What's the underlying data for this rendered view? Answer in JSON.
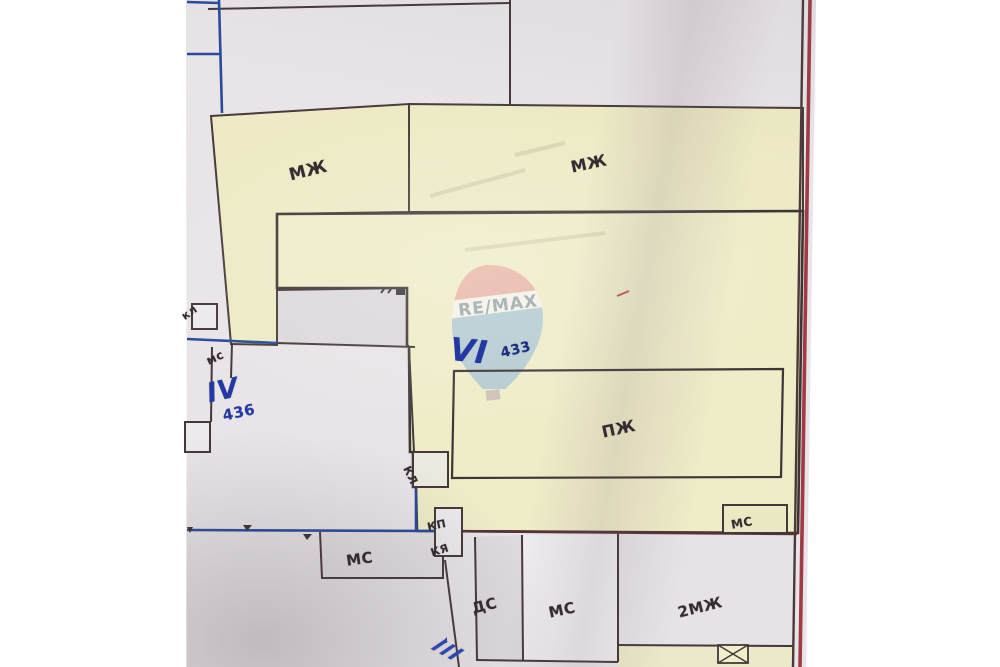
{
  "watermark": {
    "brand_text": "RE/MAX"
  },
  "map_labels": {
    "parcel_top_left_mzh": "МЖ",
    "parcel_top_right_mzh": "МЖ",
    "building_pzh": "ПЖ",
    "outbuilding_ms_right": "МС",
    "outbuilding_kl_left": "кл",
    "outbuilding_ms_left": "мс",
    "parcel_iv_roman": "IV",
    "parcel_iv_number": "436",
    "parcel_vi_roman": "VI",
    "parcel_vi_number": "433",
    "outbuilding_kl_box": "КЛ",
    "outbuilding_kp": "КП",
    "outbuilding_kya": "КЯ",
    "building_ms_bottom_left": "МС",
    "building_ds": "ДС",
    "building_ms_bottom_mid": "МС",
    "building_2mzh": "2МЖ",
    "street_iii_roman": "III"
  },
  "colors": {
    "paper": "#e8e4e7",
    "parcel_yellow": "#edeac5",
    "line_dark": "#43393a",
    "line_blue": "#2a4a9a",
    "border_red": "#a03a44",
    "annotation_blue": "#2438a2",
    "watermark_pink": "#e7a89f",
    "watermark_blue": "#a6c2d4",
    "watermark_text_grey": "#8495a2"
  }
}
